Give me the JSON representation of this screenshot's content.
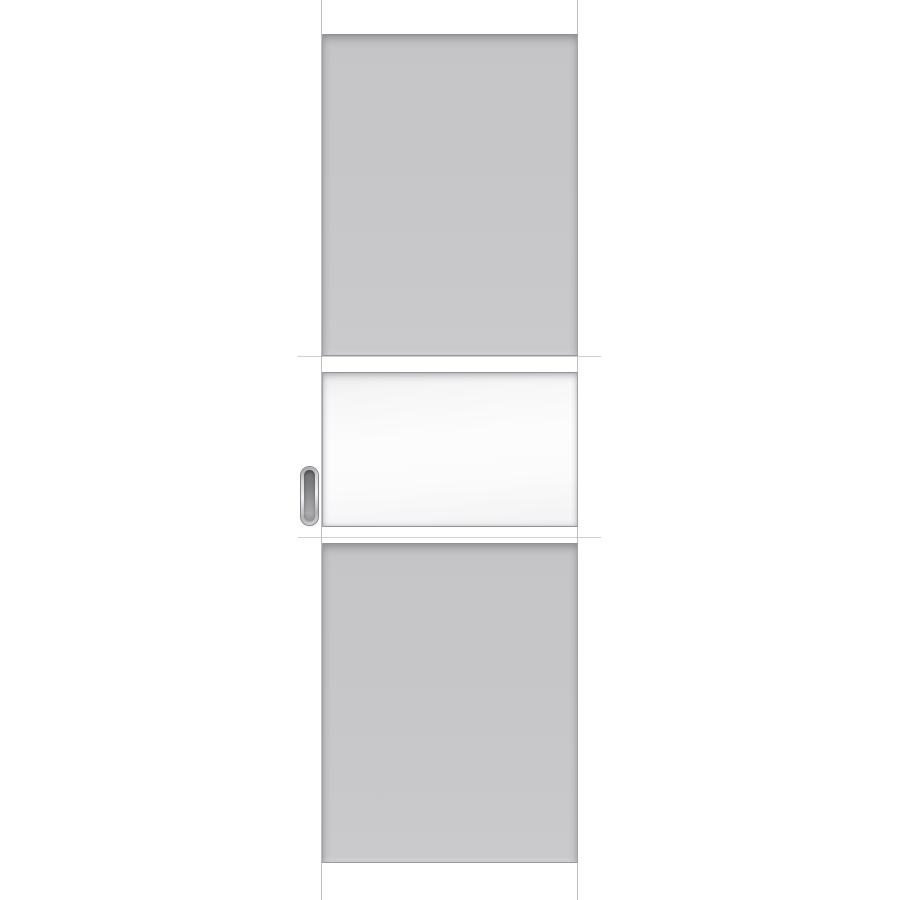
{
  "scene": {
    "type": "product-photo",
    "description": "Product photograph of a light grey interior sliding door leaf on a plain white background. Shaker-style construction: tall solid recessed panel on top, rectangular frosted white glass insert in the middle, tall solid recessed panel below. An oval chrome flush pull handle is recessed into the left stile beside the glass section.",
    "background_color": "#ffffff"
  },
  "door": {
    "finish": "light grey painted",
    "glazing": "frosted white glass, single rectangular insert",
    "parts": {
      "top_rail": "top rail",
      "left_stile": "left stile",
      "right_stile": "right stile",
      "top_panel": "solid recessed panel (upper)",
      "glass_insert": "frosted glass insert",
      "bottom_panel": "solid recessed panel (lower)",
      "bottom_rail": "bottom rail",
      "handle": "oval recessed flush pull handle, chrome finish"
    }
  },
  "theme": {
    "background": "#ffffff",
    "door_face": "#c9c9cb",
    "door_edge_highlight": "#dcdcde",
    "panel_face": "#c7c7c9",
    "recess_line_dark": "#939396",
    "recess_line_mid": "#a2a2a5",
    "joint_line": "#a9a9ac",
    "glass_white": "#fbfbfc",
    "glass_shade": "#ececed",
    "handle_ring_light": "#f0f0f2",
    "handle_ring_dark": "#a0a0a2",
    "handle_recess_dark": "#6f7072",
    "handle_recess_light": "#ababad"
  }
}
